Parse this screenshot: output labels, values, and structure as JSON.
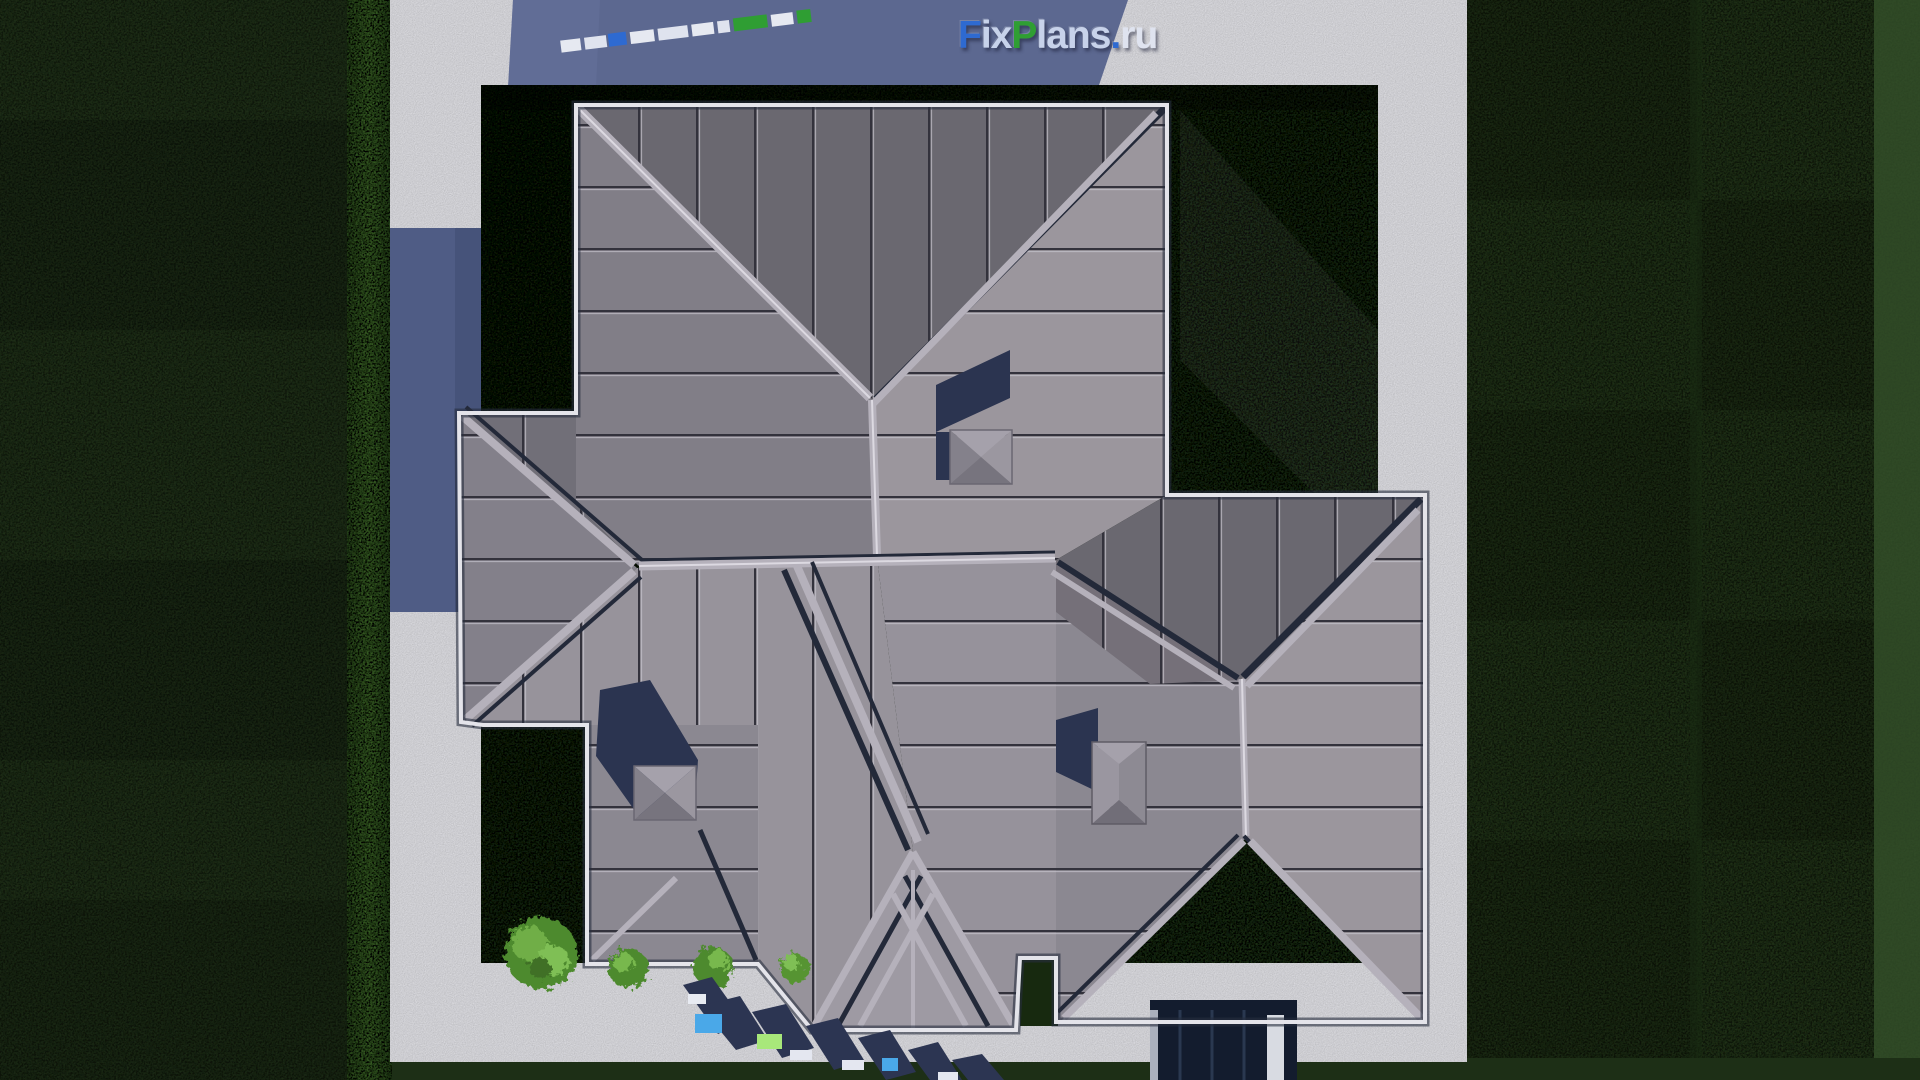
{
  "watermark": {
    "brand_f": "Fix",
    "brand_p": "Plans",
    "brand_dot": ".",
    "brand_ru": "ru",
    "logo_segments": {
      "f": "F",
      "ix": "ix",
      "p": "P",
      "lans": "lans",
      "dot": ".",
      "ru": "ru"
    }
  },
  "colors": {
    "grass_outer": "#2a3e21",
    "grass_outer_dark": "#203218",
    "grass_outer_light": "#35512a",
    "grass_inner_dark": "#142310",
    "grass_inner": "#26401d",
    "grass_strip": "#4e8034",
    "path": "#e8e8ed",
    "shadow_blue": "#5c6890",
    "shadow_blue_dark": "#4f5c85",
    "roof_dark": "#6a6870",
    "roof_dark2": "#716f78",
    "roof_mid": "#817e87",
    "roof_mid2": "#8b8891",
    "roof_light": "#97939b",
    "roof_light2": "#9b969d",
    "ridge_light": "#b5b1bb",
    "ridge_highlight": "#dcd9e1",
    "valley_navy": "#232939",
    "eave_white": "#e4e4ea",
    "eave_dark": "#262d3d",
    "chimney_shadow": "#2b3450",
    "chimney_cap": "#8f8c95",
    "garage_dark": "#131c2e",
    "bush_green": "#5d9a3a",
    "logo_blue": "#2e6ad1",
    "logo_green": "#2f9e33",
    "logo_light": "#c7d2ea",
    "logo_white": "#dfe3ef"
  }
}
